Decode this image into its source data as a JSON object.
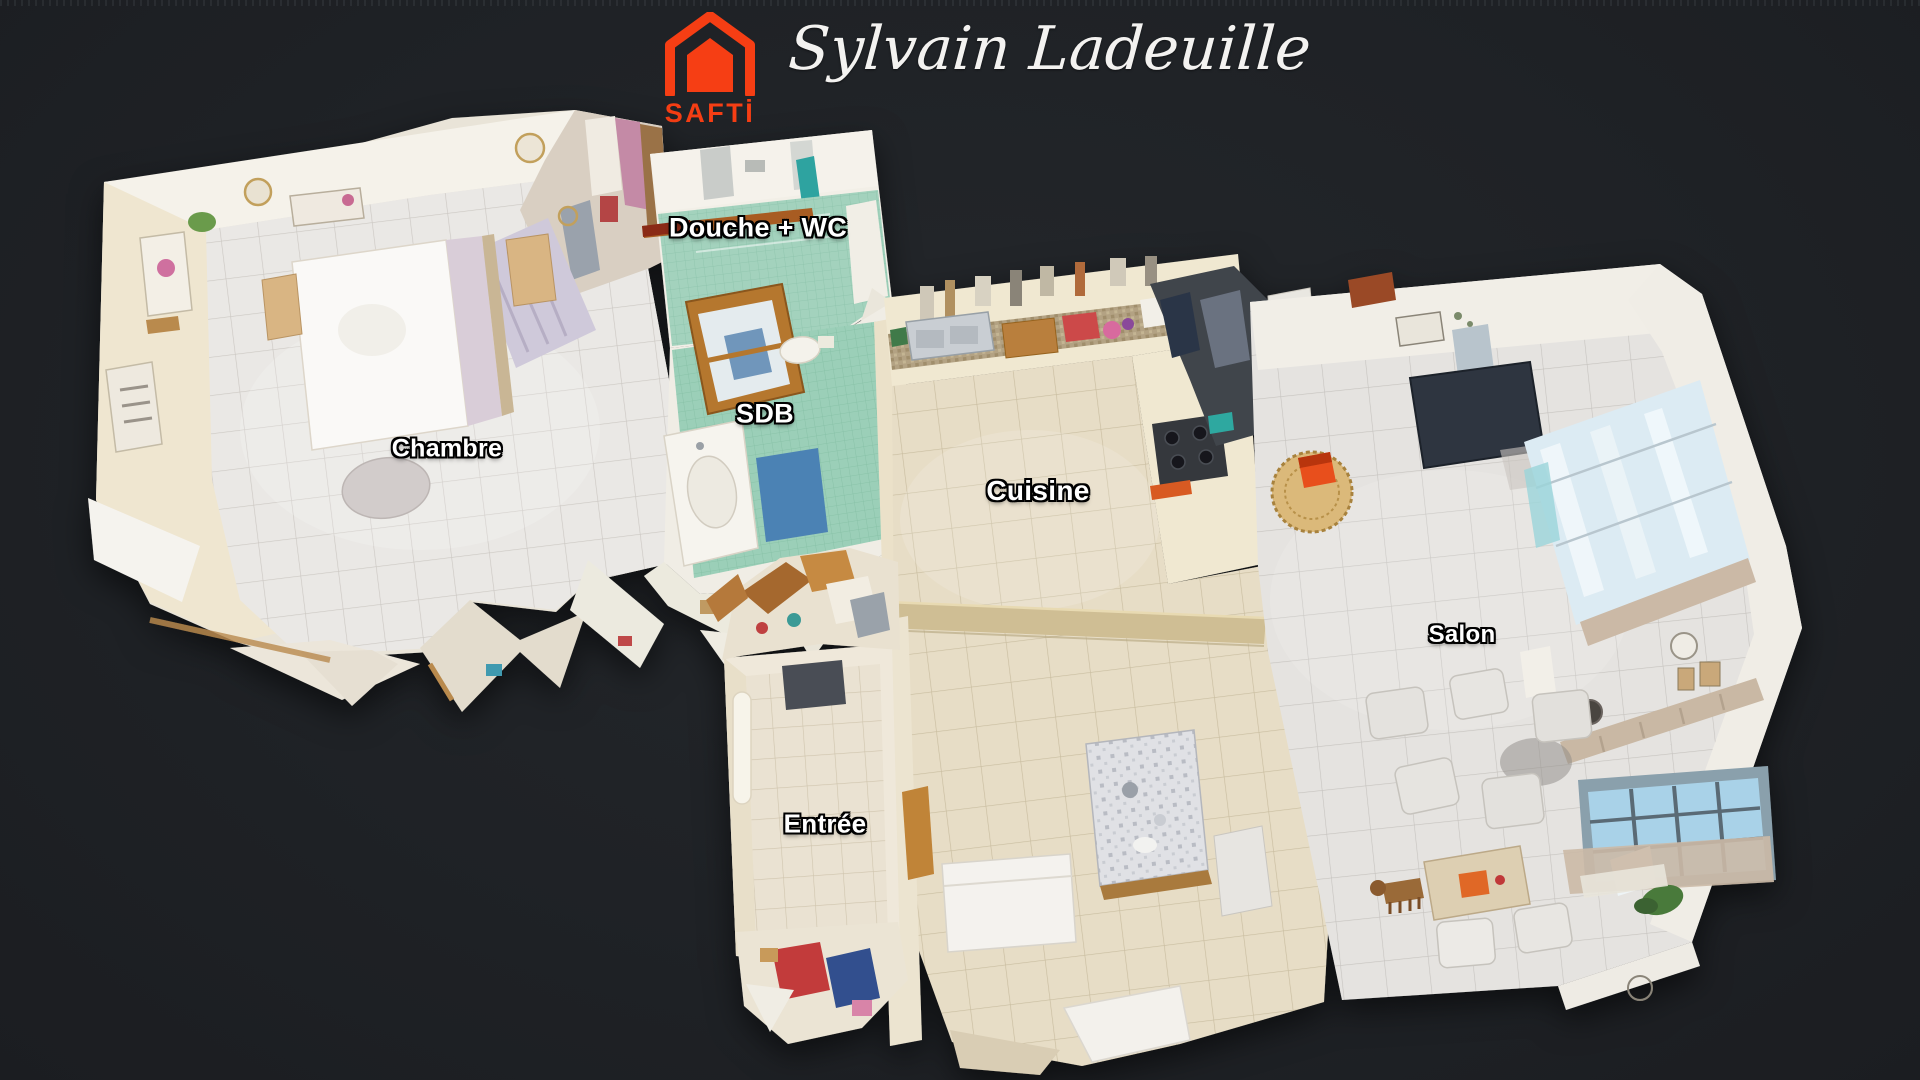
{
  "header": {
    "brand": {
      "label": "SAFTİ"
    },
    "signature": "Sylvain Ladeuille"
  },
  "palette": {
    "background": "#1f2226",
    "brand_orange": "#f63e14",
    "label_text": "#ffffff",
    "label_outline": "#000000",
    "bathroom_green": "#a3d2bd",
    "kitchen_beige": "#e7ddc6",
    "bedroom_tile_white": "#eae8e5",
    "salon_tile_gray": "#e5e3e0"
  },
  "floorplan": {
    "rooms": [
      {
        "id": "chambre",
        "label": "Chambre"
      },
      {
        "id": "douche-wc",
        "label": "Douche + WC"
      },
      {
        "id": "sdb",
        "label": "SDB"
      },
      {
        "id": "cuisine",
        "label": "Cuisine"
      },
      {
        "id": "salon",
        "label": "Salon"
      },
      {
        "id": "entree",
        "label": "Entrée"
      }
    ]
  }
}
